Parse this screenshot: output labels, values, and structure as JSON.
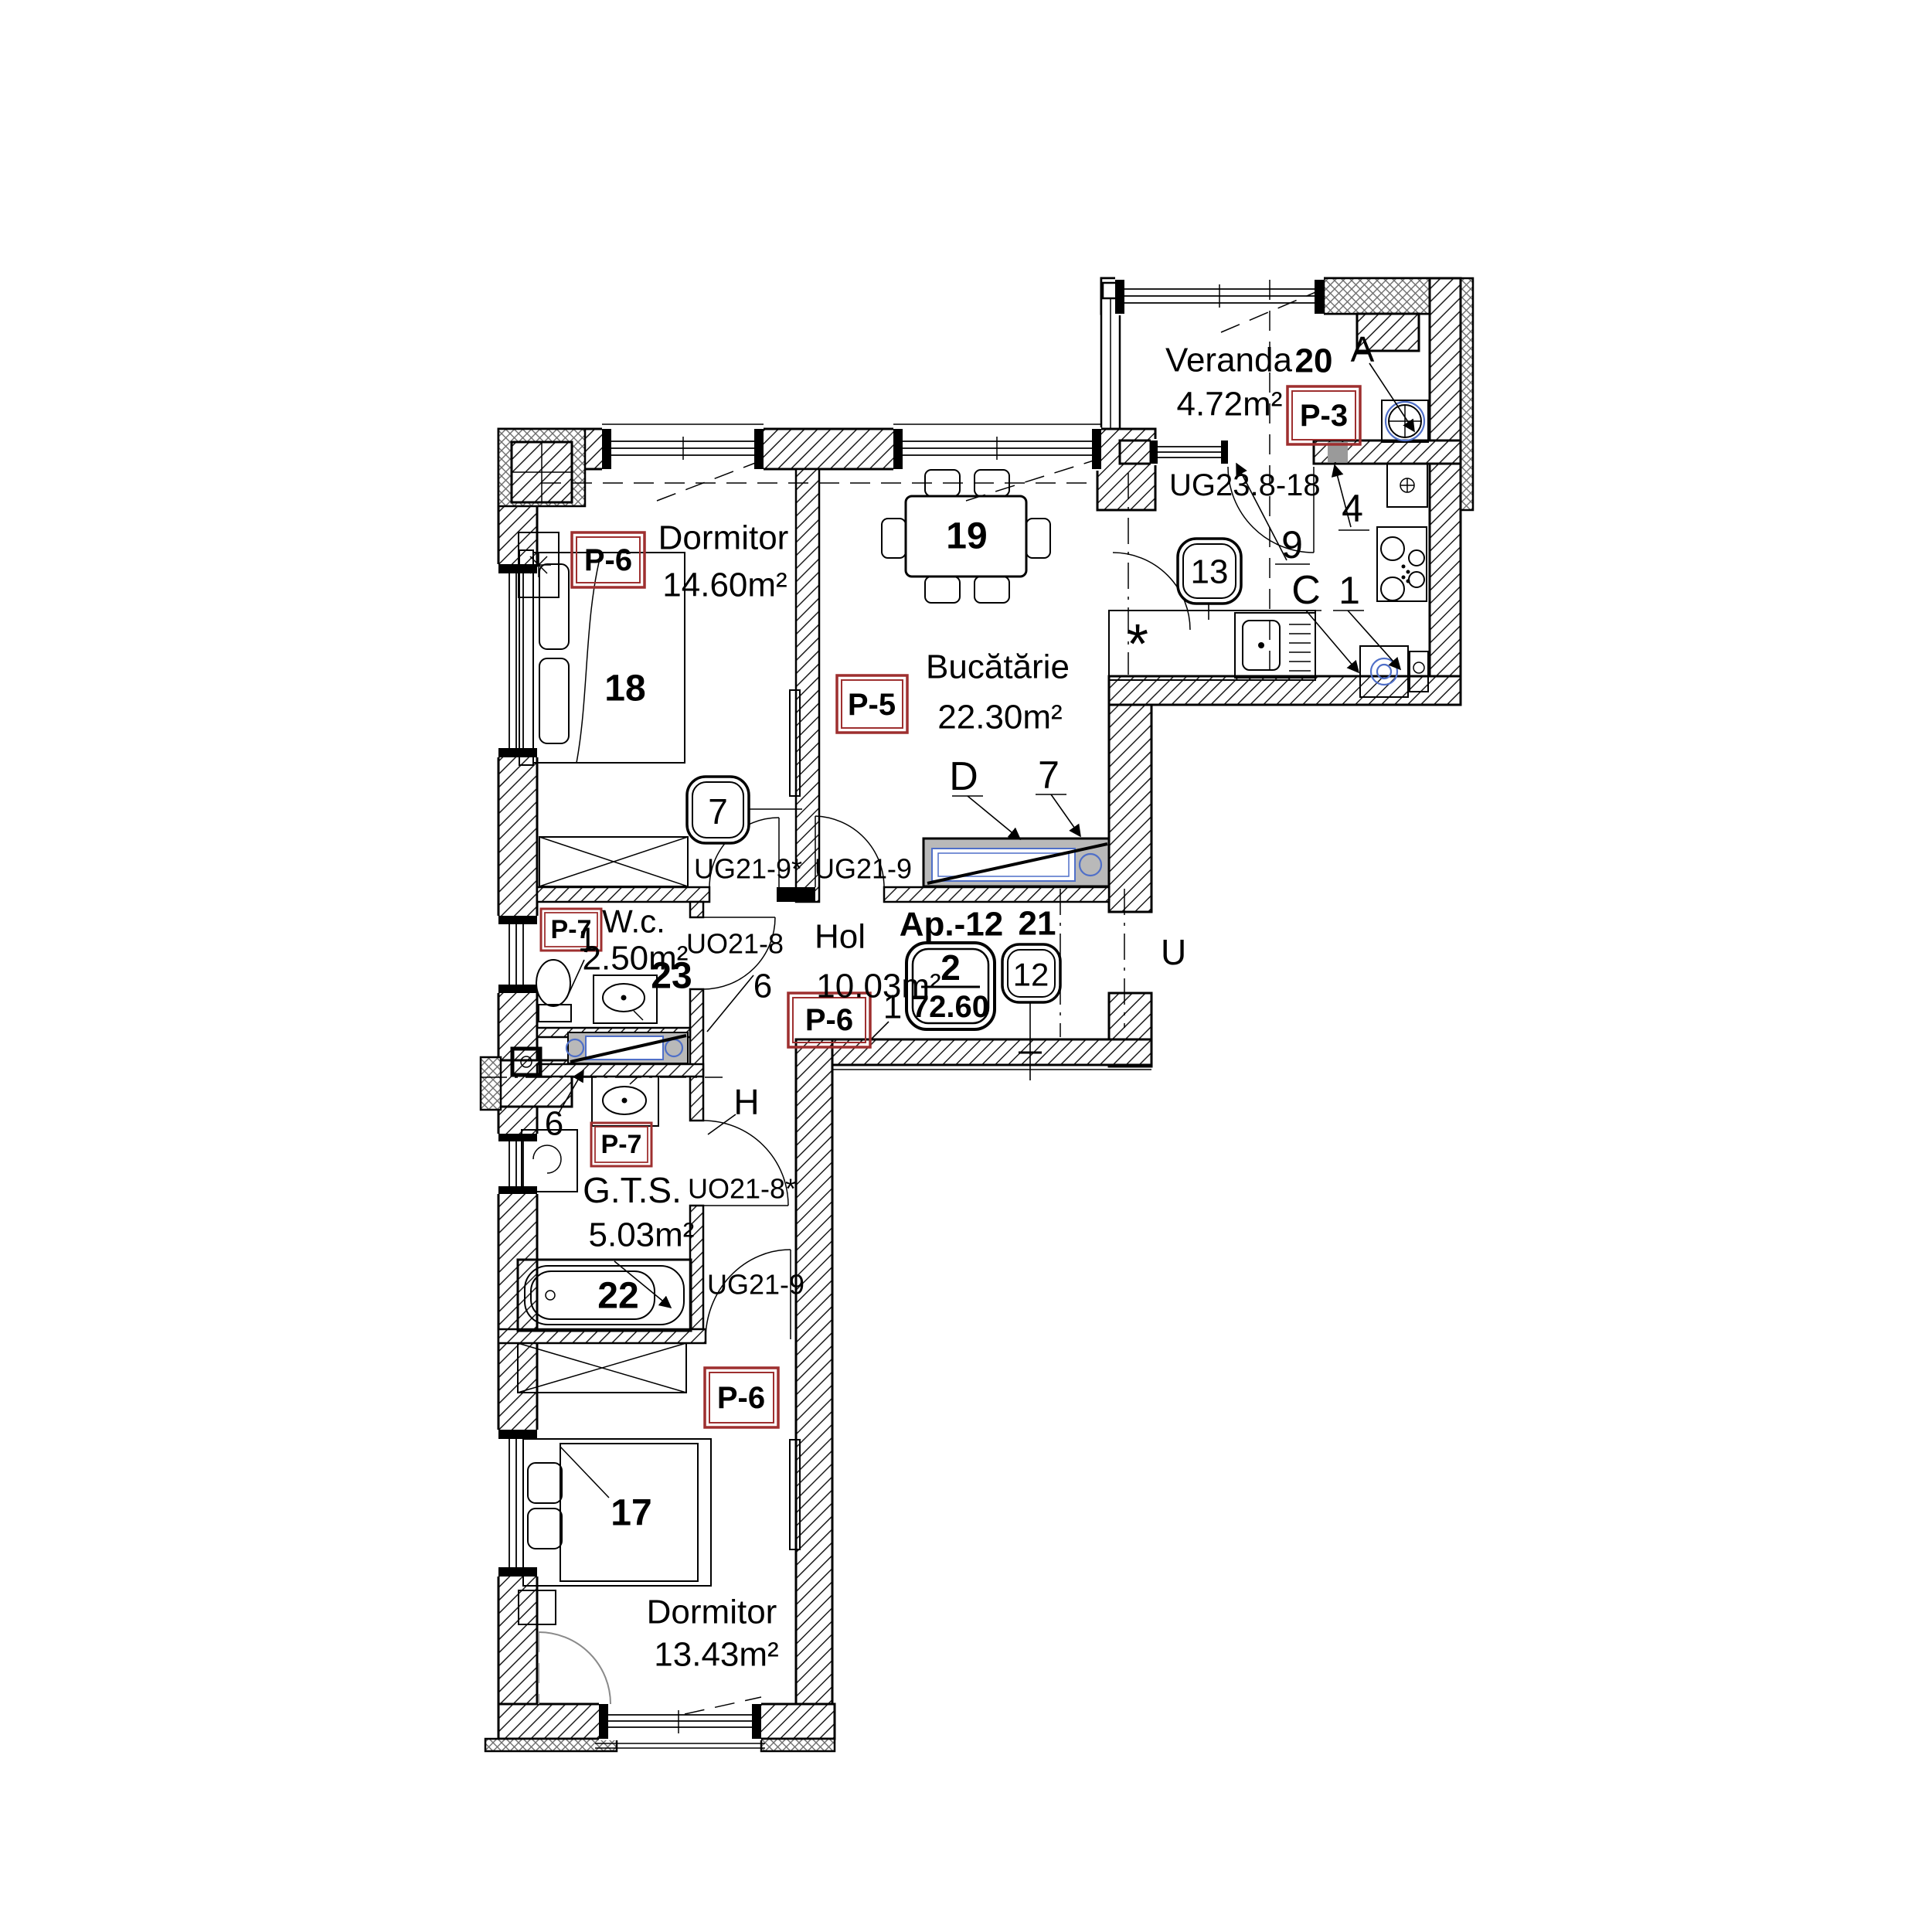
{
  "colors": {
    "accent_red": "#9e2f2f",
    "fixture_blue": "#4f6fc8",
    "lintel_gray": "#9a9a9a"
  },
  "apartment_badge": {
    "label": "Ap.-12",
    "level": "2",
    "total_area": "72.60",
    "position_label": "21",
    "position_number": "12"
  },
  "rooms": {
    "veranda": {
      "name": "Veranda",
      "number": "20",
      "area": "4.72m²",
      "finish_code": "P-3",
      "corner_marker": "A"
    },
    "dormitor_18": {
      "name": "Dormitor",
      "area": "14.60m²",
      "finish_code": "P-6",
      "furniture_number": "18",
      "door_marker": "7"
    },
    "bucatarie": {
      "name": "Bucătărie",
      "area": "22.30m²",
      "finish_code": "P-5",
      "table_number": "19",
      "counter_marker_d": "D",
      "counter_marker_7": "7",
      "kitchen_marker_9": "9",
      "kitchen_marker_4": "4",
      "kitchen_marker_c": "C",
      "kitchen_marker_1": "1",
      "kitchen_marker_13": "13",
      "kitchen_asterisk": "*"
    },
    "wc": {
      "name": "W.c.",
      "area": "2.50m²",
      "finish_code": "P-7",
      "toilet_marker": "1",
      "sink_number": "23"
    },
    "hol": {
      "name": "Hol",
      "area": "10.03m²",
      "finish_code": "P-6",
      "marker_six": "6",
      "marker_one": "1"
    },
    "gts": {
      "name": "G.T.S.",
      "area": "5.03m²",
      "finish_code": "P-7",
      "marker_six": "6",
      "tub_number": "22",
      "corridor_marker": "H",
      "bedroom_finish_code": "P-6"
    },
    "dormitor_17": {
      "name": "Dormitor",
      "area": "13.43m²",
      "furniture_number": "17"
    }
  },
  "door_codes": {
    "veranda_kitchen": "UG23.8-18",
    "dormitor_18": "UG21-9*",
    "bucatarie": "UG21-9",
    "wc": "UO21-8",
    "gts": "UO21-8*",
    "dormitor_17": "UG21-9",
    "edge_partial": "U"
  }
}
